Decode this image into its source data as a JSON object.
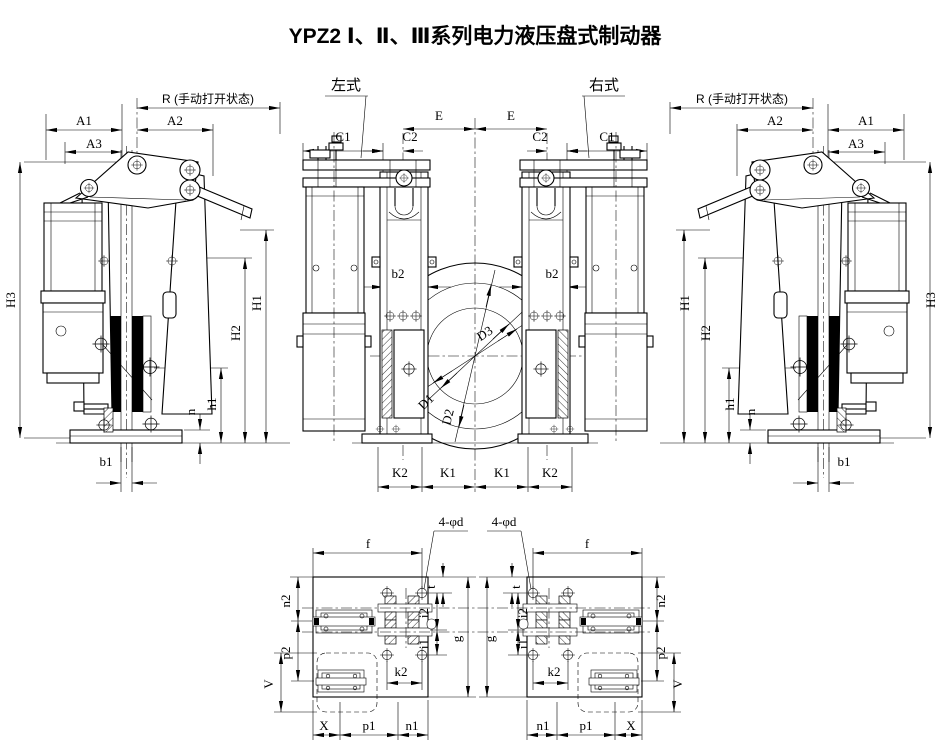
{
  "title": "YPZ2 Ⅰ、Ⅱ、Ⅲ系列电力液压盘式制动器",
  "view_labels": {
    "left_type": "左式",
    "right_type": "右式"
  },
  "dimension_labels": {
    "r_manual_open": "R (手动打开状态)",
    "a1": "A1",
    "a2": "A2",
    "a3": "A3",
    "h1_upper": "H1",
    "h2_upper": "H2",
    "h3": "H3",
    "h1_lower": "h1",
    "n": "n",
    "b1": "b1",
    "b2": "b2",
    "c1": "C1",
    "c2": "C2",
    "e": "E",
    "k1": "K1",
    "k2_upper": "K2",
    "d1": "D1",
    "d2": "D2",
    "d3": "D3",
    "f": "f",
    "mounting_holes": "4-φd",
    "n2": "n2",
    "t": "t",
    "i2": "i2",
    "i1": "i1",
    "g": "g",
    "k2_lower": "k2",
    "p2": "p2",
    "v": "V",
    "x": "X",
    "p1": "p1",
    "n1": "n1"
  }
}
